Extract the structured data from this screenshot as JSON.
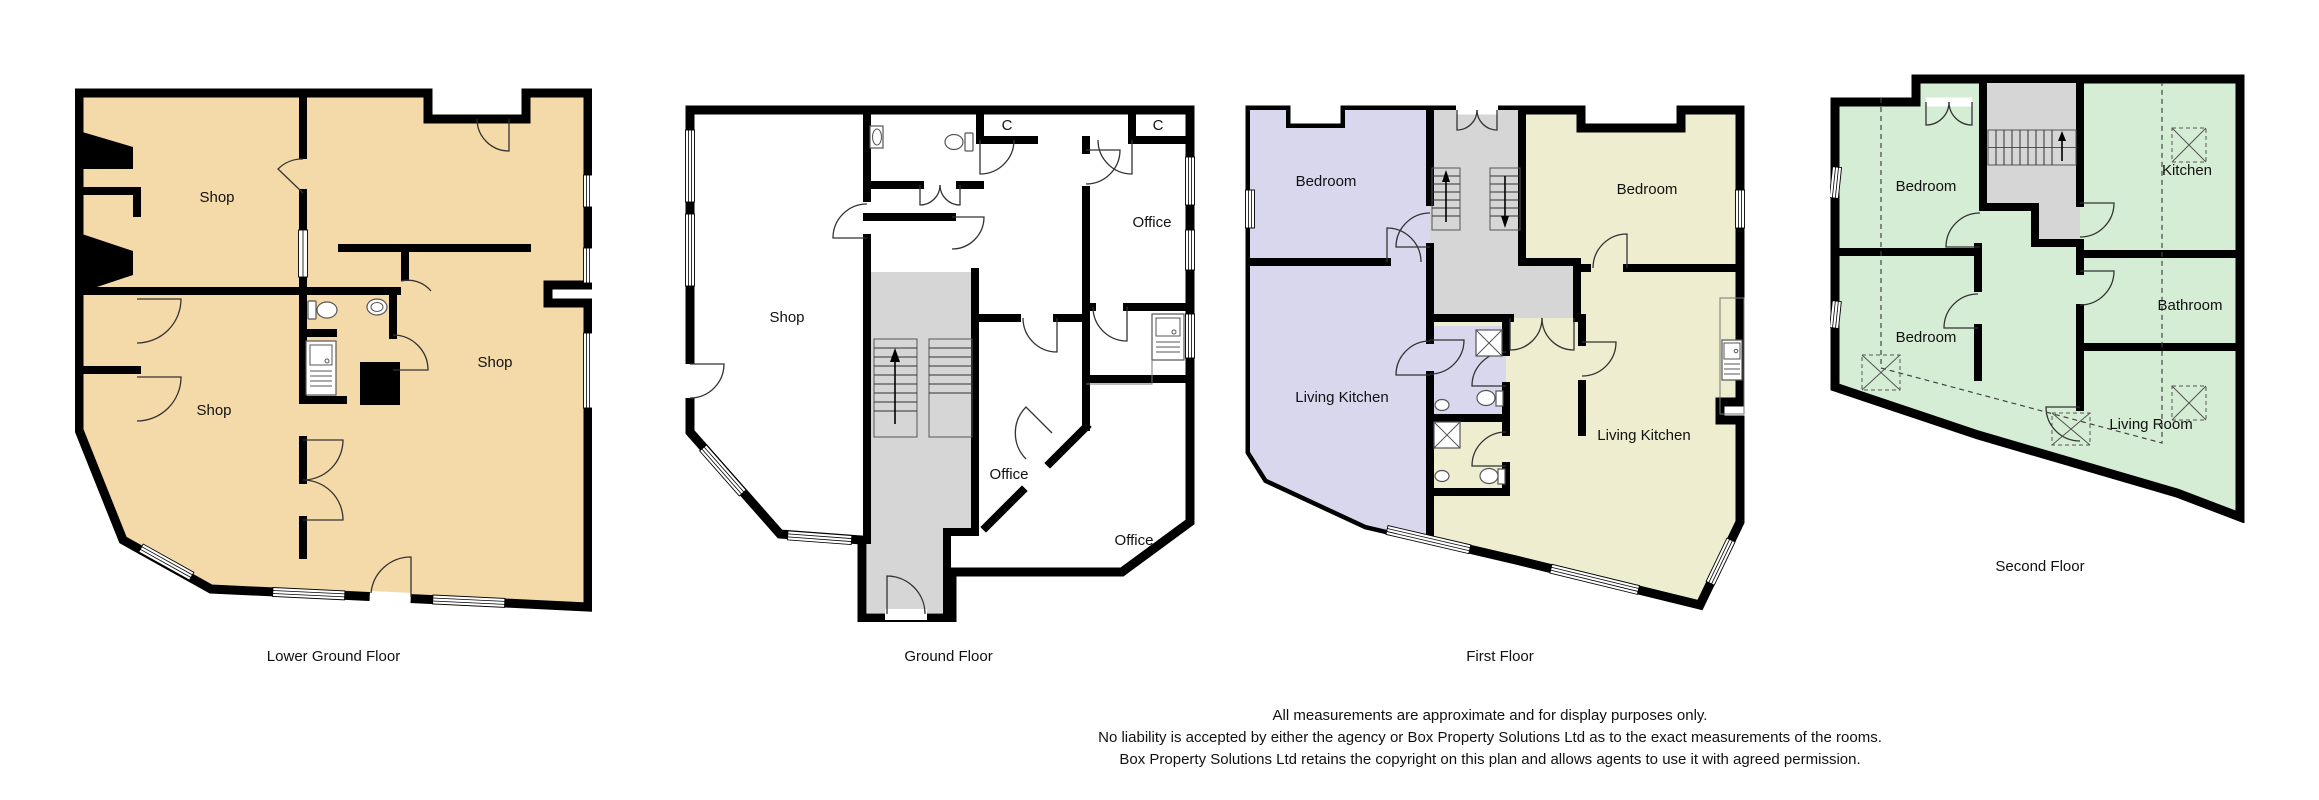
{
  "colors": {
    "lower_ground_fill": "#F5DAA9",
    "ground_fill": "#FFFFFF",
    "first_left_fill": "#D9D7EE",
    "first_right_fill": "#EFEDCF",
    "second_fill": "#D5EDD4",
    "stair_fill": "#D6D6D6",
    "wall": "#000000"
  },
  "floors": [
    {
      "caption": "Lower Ground Floor",
      "rooms": {
        "shop_upper": "Shop",
        "shop_right": "Shop",
        "shop_lower": "Shop"
      }
    },
    {
      "caption": "Ground Floor",
      "rooms": {
        "shop": "Shop",
        "office_top": "Office",
        "office_middle": "Office",
        "office_bottom": "Office",
        "closet_left": "C",
        "closet_right": "C"
      }
    },
    {
      "caption": "First Floor",
      "rooms": {
        "bedroom_left": "Bedroom",
        "bedroom_right": "Bedroom",
        "living_kitchen_left": "Living Kitchen",
        "living_kitchen_right": "Living Kitchen"
      }
    },
    {
      "caption": "Second Floor",
      "rooms": {
        "bedroom_top": "Bedroom",
        "bedroom_middle": "Bedroom",
        "kitchen": "Kitchen",
        "bathroom": "Bathroom",
        "living_room": "Living Room"
      }
    }
  ],
  "disclaimer": {
    "line1": "All measurements are approximate and for display purposes only.",
    "line2": "No liability is accepted by either the agency or Box Property Solutions Ltd as to the exact measurements of the rooms.",
    "line3": "Box Property Solutions Ltd retains the copyright on this plan and allows agents to use it with agreed permission."
  }
}
